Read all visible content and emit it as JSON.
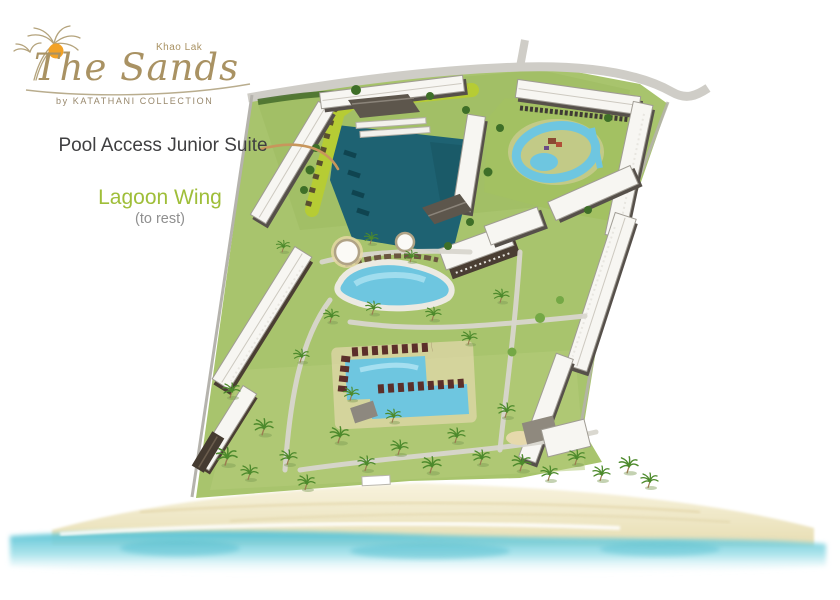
{
  "brand": {
    "location_tag": "Khao Lak",
    "name": "The Sands",
    "byline": "by KATATHANI COLLECTION"
  },
  "annotations": {
    "room_label": "Pool Access Junior Suite",
    "wing_label": "Lagoon Wing",
    "wing_sublabel": "(to rest)"
  },
  "map_legend": {
    "highlighted_feature": "Pool Access Junior Suite wing (highlighted green along lagoon)",
    "water_features": [
      "lagoon",
      "free-form pool",
      "family pool complex",
      "kids water play pool",
      "beach and sea"
    ]
  },
  "colors": {
    "logo_tan": "#a99263",
    "sun_orange": "#f2a227",
    "label_dark": "#3f3f41",
    "wing_green": "#9fbe39",
    "sublabel_gray": "#8f8f8f",
    "arrow_tan": "#c8965c",
    "highlight_wing": "#b6cc34",
    "lagoon_teal": "#1e6272",
    "pool_blue": "#6ec6e0",
    "lawn_green": "#a8c46d",
    "sand": "#efe7c4",
    "sea_turquoise": "#63c5d6"
  }
}
